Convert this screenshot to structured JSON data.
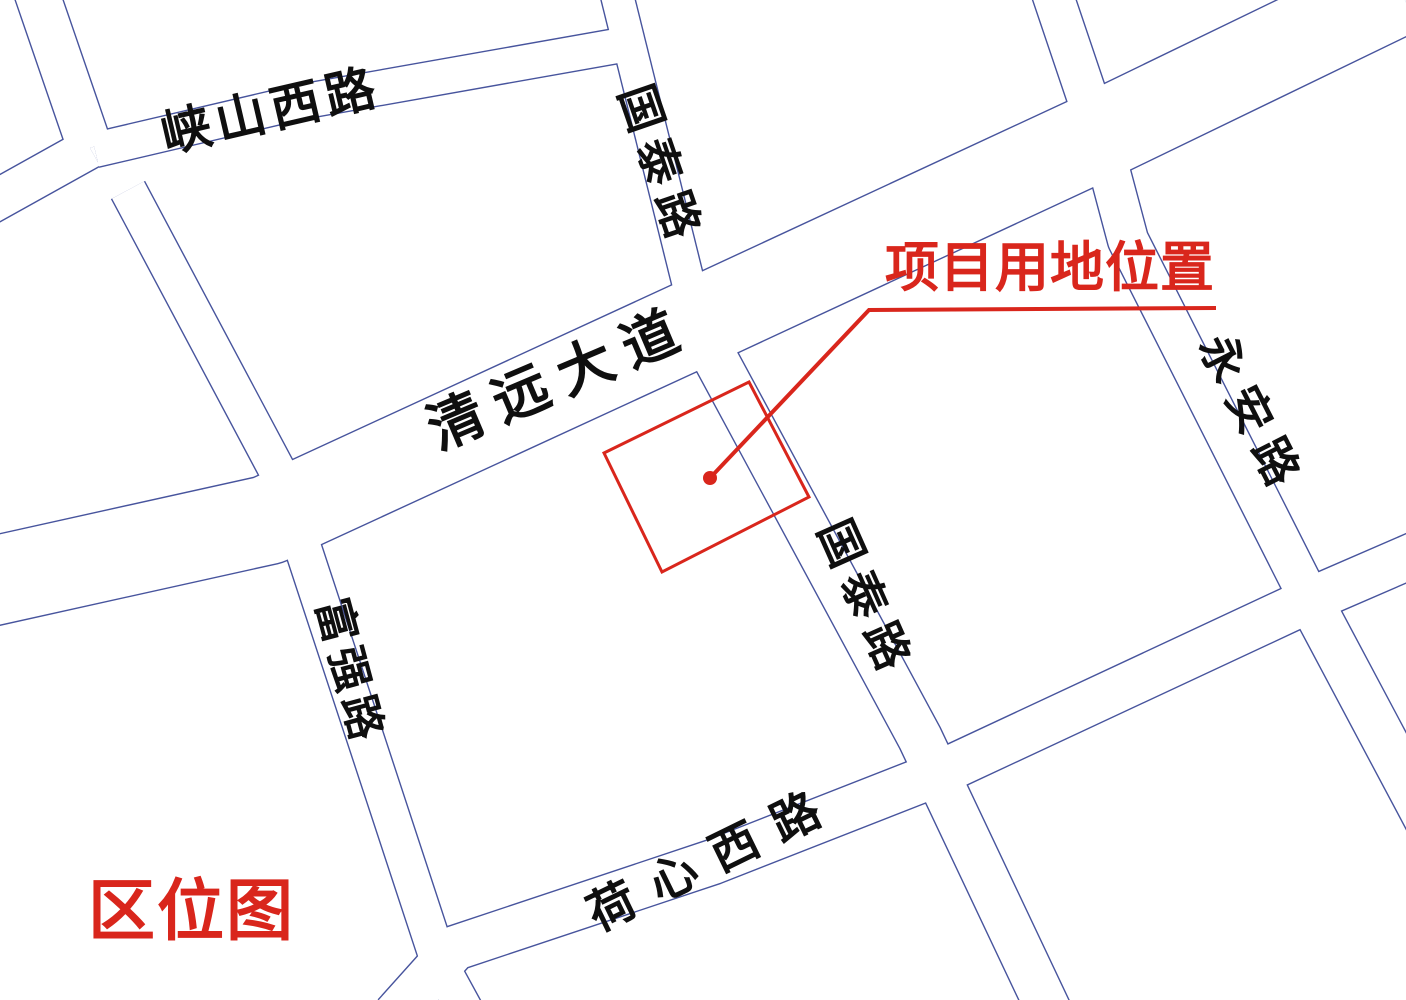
{
  "title": {
    "text": "区位图"
  },
  "annotation": {
    "label": "项目用地位置"
  },
  "colors": {
    "background": "#ffffff",
    "road_line": "#47549d",
    "road_surface": "#ffffff",
    "accent_red": "#d9261c",
    "label_black": "#0f0f0f"
  },
  "map": {
    "roads": [
      {
        "name": "清远大道",
        "width": 88,
        "points": [
          [
            -25,
            585
          ],
          [
            268,
            520
          ],
          [
            724,
            310
          ],
          [
            1090,
            140
          ],
          [
            1400,
            -10
          ]
        ]
      },
      {
        "name": "峡山西路",
        "width": 34,
        "points": [
          [
            95,
            150
          ],
          [
            300,
            102
          ],
          [
            628,
            44
          ]
        ]
      },
      {
        "name": "国泰路北段",
        "width": 32,
        "points": [
          [
            612,
            -25
          ],
          [
            700,
            330
          ]
        ]
      },
      {
        "name": "国泰路南段",
        "width": 44,
        "points": [
          [
            700,
            330
          ],
          [
            920,
            738
          ],
          [
            1051,
            1015
          ]
        ]
      },
      {
        "name": "永安路北段",
        "width": 40,
        "points": [
          [
            1046,
            -25
          ],
          [
            1100,
            135
          ],
          [
            1128,
            240
          ],
          [
            1310,
            600
          ]
        ]
      },
      {
        "name": "永安路南段",
        "width": 44,
        "points": [
          [
            1310,
            600
          ],
          [
            1428,
            822
          ]
        ]
      },
      {
        "name": "荷心西路",
        "width": 44,
        "points": [
          [
            395,
            1015
          ],
          [
            455,
            948
          ],
          [
            713,
            862
          ],
          [
            935,
            775
          ],
          [
            1310,
            600
          ],
          [
            1430,
            548
          ]
        ]
      },
      {
        "name": "富强路",
        "width": 36,
        "points": [
          [
            128,
            190
          ],
          [
            278,
            472
          ],
          [
            440,
            965
          ],
          [
            470,
            1020
          ]
        ]
      },
      {
        "name": "支路北",
        "width": 44,
        "points": [
          [
            34,
            -15
          ],
          [
            90,
            148
          ]
        ]
      },
      {
        "name": "支路西",
        "width": 40,
        "points": [
          [
            90,
            148
          ],
          [
            -25,
            212
          ]
        ]
      }
    ],
    "labels": [
      {
        "text": "峡山西路",
        "x": 271,
        "y": 111,
        "rotate": -13,
        "size": 50,
        "spacing": 6
      },
      {
        "text": "国泰路",
        "x": 661,
        "y": 166,
        "rotate": 71,
        "size": 46,
        "spacing": 10
      },
      {
        "text": "清远大道",
        "x": 560,
        "y": 379,
        "rotate": -23,
        "size": 56,
        "spacing": 14
      },
      {
        "text": "永安路",
        "x": 1252,
        "y": 415,
        "rotate": 63,
        "size": 46,
        "spacing": 12
      },
      {
        "text": "国泰路",
        "x": 866,
        "y": 599,
        "rotate": 66,
        "size": 46,
        "spacing": 10
      },
      {
        "text": "富强路",
        "x": 349,
        "y": 672,
        "rotate": 75,
        "size": 44,
        "spacing": 6
      },
      {
        "text": "荷心西路",
        "x": 713,
        "y": 858,
        "rotate": -26,
        "size": 48,
        "spacing": 20
      }
    ],
    "site": {
      "polygon": [
        [
          749,
          382
        ],
        [
          809,
          497
        ],
        [
          662,
          572
        ],
        [
          604,
          453
        ]
      ],
      "dot": {
        "x": 710,
        "y": 478,
        "r": 7
      },
      "leader": [
        [
          710,
          478
        ],
        [
          869,
          310
        ],
        [
          1216,
          308
        ]
      ],
      "boundary_stroke": 3,
      "leader_stroke": 4
    }
  }
}
